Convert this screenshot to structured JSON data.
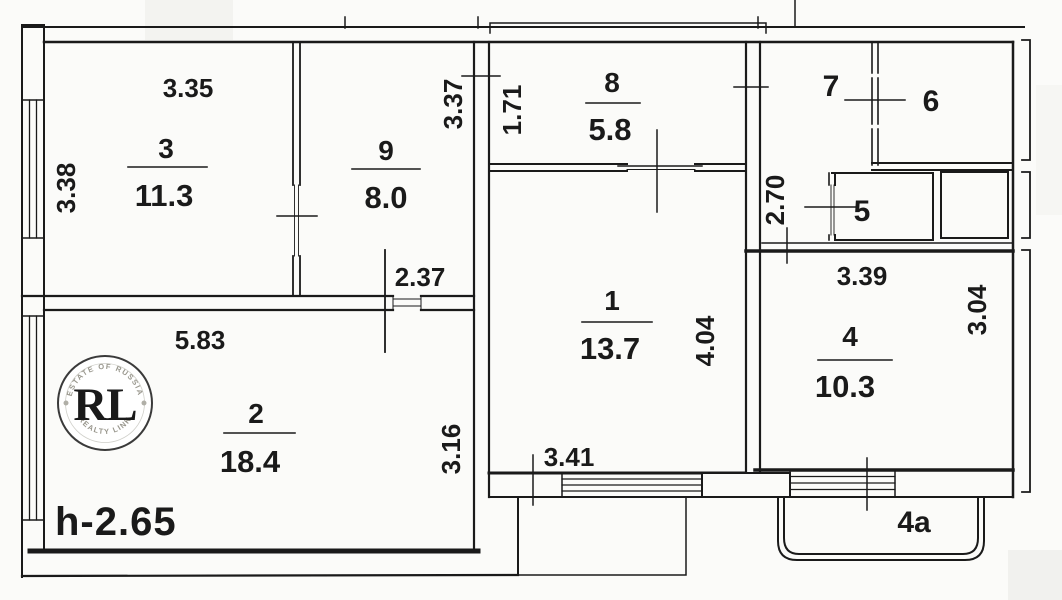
{
  "canvas": {
    "width": 1062,
    "height": 600,
    "background": "#fbfbf9",
    "ink": "#1a1a1a"
  },
  "annotations": {
    "ceiling_height": "h-2.65",
    "balcony": "4a"
  },
  "rooms": [
    {
      "id": "room-1",
      "number": "1",
      "area": "13.7"
    },
    {
      "id": "room-2",
      "number": "2",
      "area": "18.4"
    },
    {
      "id": "room-3",
      "number": "3",
      "area": "11.3"
    },
    {
      "id": "room-4",
      "number": "4",
      "area": "10.3"
    },
    {
      "id": "room-5",
      "number": "5"
    },
    {
      "id": "room-6",
      "number": "6"
    },
    {
      "id": "room-7",
      "number": "7"
    },
    {
      "id": "room-8",
      "number": "8",
      "area": "5.8"
    },
    {
      "id": "room-9",
      "number": "9",
      "area": "8.0"
    }
  ],
  "dimensions": [
    {
      "value": "3.35",
      "edge": "room-3-top"
    },
    {
      "value": "3.38",
      "edge": "room-3-left"
    },
    {
      "value": "3.37",
      "edge": "room-9-right"
    },
    {
      "value": "2.37",
      "edge": "room-9-bottom"
    },
    {
      "value": "1.71",
      "edge": "room-8-left"
    },
    {
      "value": "2.70",
      "edge": "hall-left"
    },
    {
      "value": "3.39",
      "edge": "room-4-top"
    },
    {
      "value": "3.04",
      "edge": "room-4-right"
    },
    {
      "value": "4.04",
      "edge": "room-1-right"
    },
    {
      "value": "3.41",
      "edge": "room-1-bottom"
    },
    {
      "value": "5.83",
      "edge": "room-2-top"
    },
    {
      "value": "3.16",
      "edge": "room-2-right"
    }
  ],
  "logo": {
    "monogram": "RL",
    "arc_top": "ESTATE OF RUSSIA",
    "arc_bottom": "REALTY LINK",
    "gold": "#c79f35",
    "ring": "#3a3a3a"
  }
}
